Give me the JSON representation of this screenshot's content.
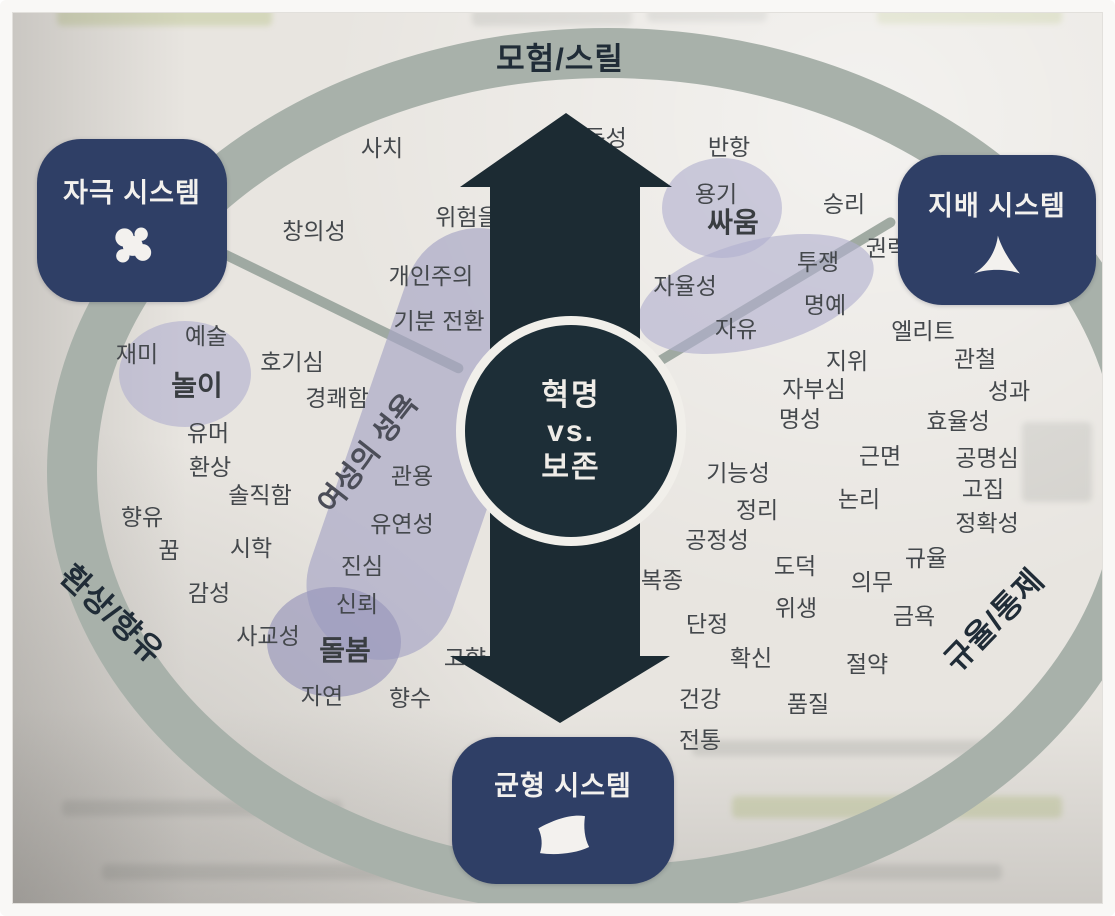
{
  "diagram": {
    "ring_labels": {
      "top": "모험/스릴",
      "bottom_left": "환상/향유",
      "bottom_right": "규율/통제"
    },
    "center": {
      "line1": "혁명",
      "line2": "vs.",
      "line3": "보존"
    },
    "systems": {
      "stimulation": {
        "label": "자극 시스템",
        "icon": "splash-icon"
      },
      "dominance": {
        "label": "지배 시스템",
        "icon": "fin-icon"
      },
      "balance": {
        "label": "균형 시스템",
        "icon": "cushion-icon"
      }
    },
    "region_label": "여성의 성욕",
    "words": [
      {
        "t": "사치",
        "x": 370,
        "y": 134
      },
      {
        "t": "충동성",
        "x": 583,
        "y": 124
      },
      {
        "t": "반항",
        "x": 717,
        "y": 133
      },
      {
        "t": "위험을",
        "x": 455,
        "y": 203
      },
      {
        "t": "창의성",
        "x": 302,
        "y": 217
      },
      {
        "t": "용기",
        "x": 704,
        "y": 180
      },
      {
        "t": "싸움",
        "x": 721,
        "y": 209,
        "b": true
      },
      {
        "t": "승리",
        "x": 832,
        "y": 190
      },
      {
        "t": "권력",
        "x": 875,
        "y": 234
      },
      {
        "t": "투쟁",
        "x": 806,
        "y": 248
      },
      {
        "t": "개인주의",
        "x": 419,
        "y": 262
      },
      {
        "t": "기분 전환",
        "x": 427,
        "y": 307
      },
      {
        "t": "자율성",
        "x": 673,
        "y": 272
      },
      {
        "t": "자유",
        "x": 724,
        "y": 315
      },
      {
        "t": "명예",
        "x": 813,
        "y": 291
      },
      {
        "t": "엘리트",
        "x": 911,
        "y": 317
      },
      {
        "t": "재미",
        "x": 125,
        "y": 340
      },
      {
        "t": "예술",
        "x": 194,
        "y": 322
      },
      {
        "t": "호기심",
        "x": 280,
        "y": 348
      },
      {
        "t": "지위",
        "x": 835,
        "y": 347
      },
      {
        "t": "관철",
        "x": 963,
        "y": 345
      },
      {
        "t": "놀이",
        "x": 185,
        "y": 372,
        "b": true
      },
      {
        "t": "경쾌함",
        "x": 325,
        "y": 384
      },
      {
        "t": "자부심",
        "x": 802,
        "y": 375
      },
      {
        "t": "성과",
        "x": 997,
        "y": 377
      },
      {
        "t": "명성",
        "x": 788,
        "y": 405
      },
      {
        "t": "효율성",
        "x": 946,
        "y": 407
      },
      {
        "t": "유머",
        "x": 196,
        "y": 419
      },
      {
        "t": "환상",
        "x": 198,
        "y": 453
      },
      {
        "t": "관용",
        "x": 400,
        "y": 462
      },
      {
        "t": "근면",
        "x": 868,
        "y": 442
      },
      {
        "t": "공명심",
        "x": 975,
        "y": 444
      },
      {
        "t": "기능성",
        "x": 726,
        "y": 459
      },
      {
        "t": "고집",
        "x": 971,
        "y": 475
      },
      {
        "t": "논리",
        "x": 847,
        "y": 485
      },
      {
        "t": "솔직함",
        "x": 248,
        "y": 481
      },
      {
        "t": "향유",
        "x": 130,
        "y": 503
      },
      {
        "t": "유연성",
        "x": 390,
        "y": 510
      },
      {
        "t": "정확성",
        "x": 975,
        "y": 509
      },
      {
        "t": "정리",
        "x": 745,
        "y": 496
      },
      {
        "t": "공정성",
        "x": 705,
        "y": 526
      },
      {
        "t": "꿈",
        "x": 157,
        "y": 536
      },
      {
        "t": "시학",
        "x": 239,
        "y": 534
      },
      {
        "t": "진심",
        "x": 350,
        "y": 552
      },
      {
        "t": "도덕",
        "x": 783,
        "y": 552
      },
      {
        "t": "규율",
        "x": 914,
        "y": 544
      },
      {
        "t": "의무",
        "x": 860,
        "y": 568
      },
      {
        "t": "복종",
        "x": 650,
        "y": 566
      },
      {
        "t": "감성",
        "x": 197,
        "y": 579
      },
      {
        "t": "신뢰",
        "x": 345,
        "y": 590
      },
      {
        "t": "위생",
        "x": 784,
        "y": 594
      },
      {
        "t": "금욕",
        "x": 902,
        "y": 602
      },
      {
        "t": "단정",
        "x": 695,
        "y": 610
      },
      {
        "t": "사교성",
        "x": 256,
        "y": 622
      },
      {
        "t": "돌봄",
        "x": 333,
        "y": 637,
        "b": true
      },
      {
        "t": "고향",
        "x": 453,
        "y": 644
      },
      {
        "t": "확신",
        "x": 739,
        "y": 644
      },
      {
        "t": "절약",
        "x": 855,
        "y": 650
      },
      {
        "t": "자연",
        "x": 310,
        "y": 682
      },
      {
        "t": "향수",
        "x": 398,
        "y": 684
      },
      {
        "t": "건강",
        "x": 688,
        "y": 685
      },
      {
        "t": "품질",
        "x": 796,
        "y": 690
      },
      {
        "t": "전통",
        "x": 688,
        "y": 726
      }
    ]
  },
  "colors": {
    "page": "#e8e5e0",
    "ring": "#a8b1aa",
    "box": "#2f3f66",
    "arrow": "#1c2b33",
    "circle": "#1d2e37",
    "word": "#44484c"
  }
}
